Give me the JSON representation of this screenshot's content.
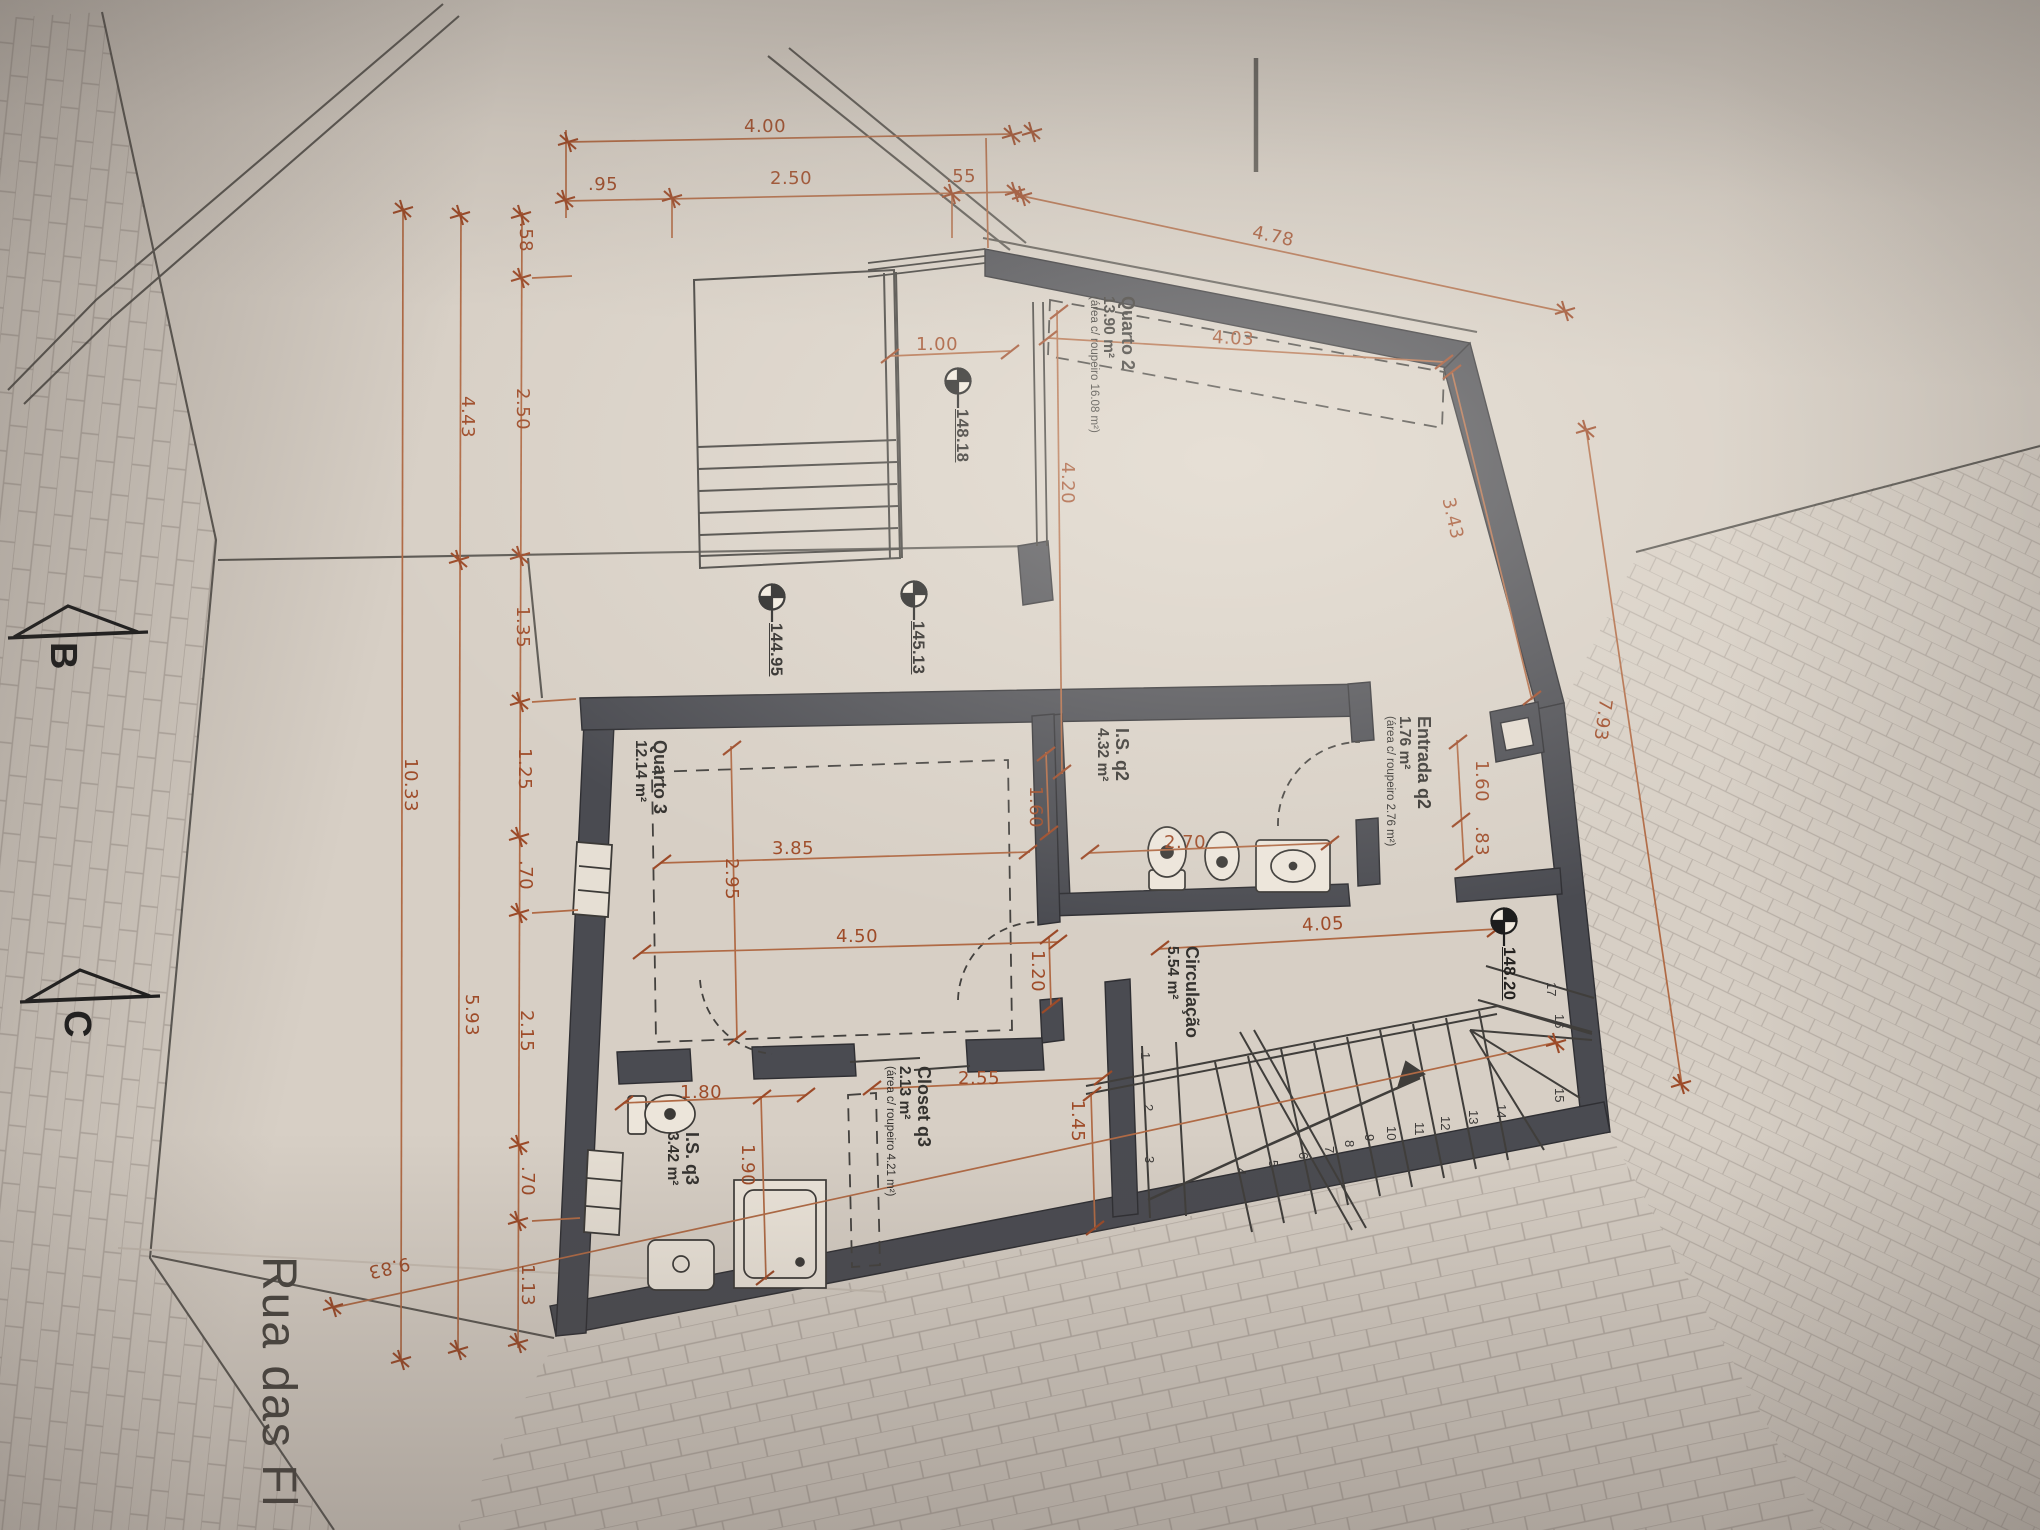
{
  "palette": {
    "dim_color": "#9e4b28",
    "line_color": "#45423e",
    "wall_color": "#4a4b51",
    "paper": "#d7cfc5"
  },
  "street": {
    "name": "Rua das Fl",
    "section_b": "B",
    "section_c": "C"
  },
  "levels": [
    {
      "value": "148.18"
    },
    {
      "value": "144.95"
    },
    {
      "value": "145.13"
    },
    {
      "value": "148.20"
    }
  ],
  "rooms": [
    {
      "name": "Quarto 2",
      "area": "13.90 m²",
      "note": "(área c/ roupeiro 16.08 m²)"
    },
    {
      "name": "Entrada q2",
      "area": "1.76 m²",
      "note": "(área c/ roupeiro 2.76 m²)"
    },
    {
      "name": "I.S. q2",
      "area": "4.32 m²",
      "note": ""
    },
    {
      "name": "Quarto 3",
      "area": "12.14 m²",
      "note": ""
    },
    {
      "name": "Circulação",
      "area": "5.54 m²",
      "note": ""
    },
    {
      "name": "Closet q3",
      "area": "2.13 m²",
      "note": "(área c/ roupeiro 4.21 m²)"
    },
    {
      "name": "I.S. q3",
      "area": "3.42 m²",
      "note": ""
    }
  ],
  "dims": {
    "top_total": "4.00",
    "top_chain": [
      ".95",
      "2.50",
      ".55"
    ],
    "top_diagonal": "4.78",
    "left_total": "10.33",
    "left_pair": [
      "4.43",
      "5.93"
    ],
    "left_chain": [
      ".58",
      "2.50",
      "1.35",
      "1.25",
      ".70",
      "2.15",
      ".70",
      "1.13"
    ],
    "right_total": "7.93",
    "site_diagonal": "9.83",
    "interior": [
      "4.03",
      "3.43",
      "4.20",
      "1.00",
      "1.60",
      "2.70",
      ".83",
      "4.05",
      "1.20",
      "3.85",
      "2.95",
      "4.50",
      "1.80",
      "1.90",
      "2.55",
      "1.45",
      "1.60"
    ]
  },
  "stairs": {
    "numbers": [
      "1",
      "2",
      "3",
      "4",
      "5",
      "6",
      "7",
      "8",
      "9",
      "10",
      "11",
      "12",
      "13",
      "14",
      "15",
      "16",
      "17"
    ]
  }
}
